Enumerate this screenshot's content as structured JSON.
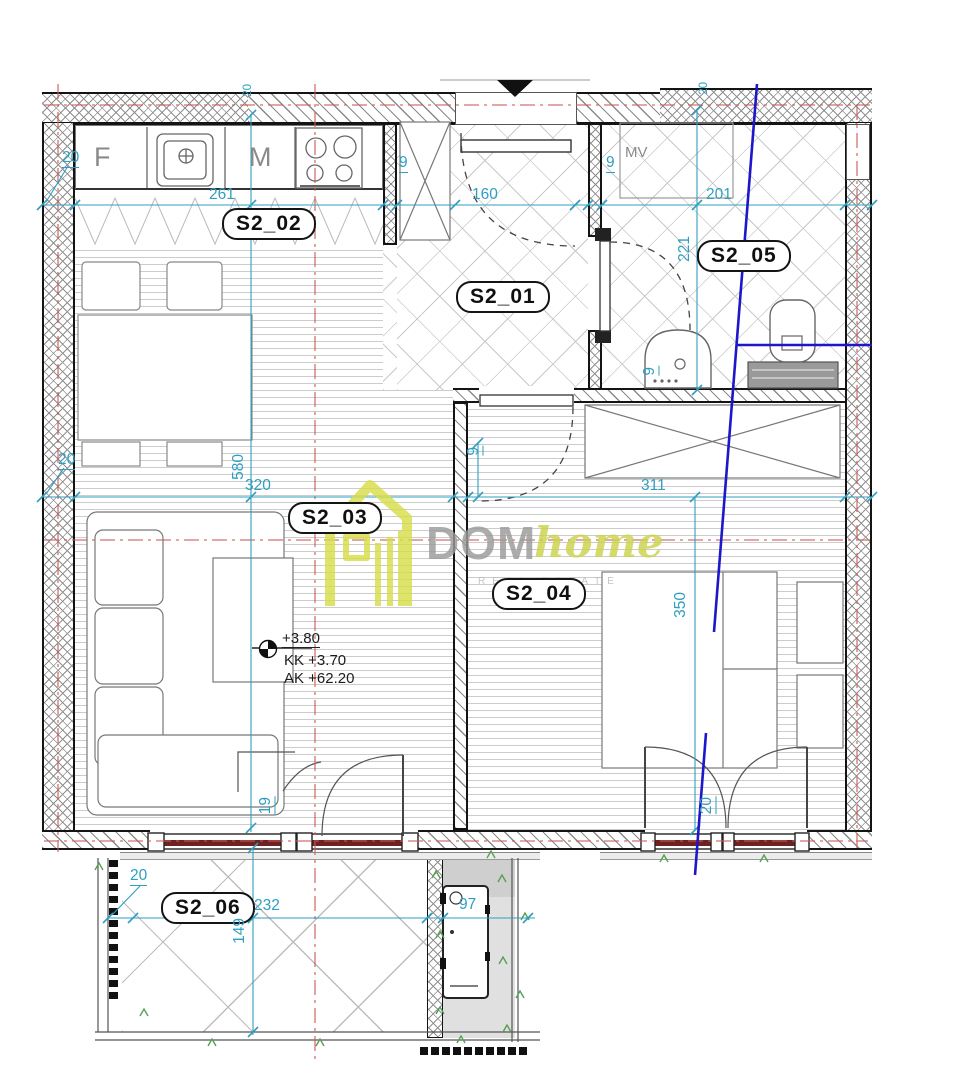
{
  "rooms": [
    {
      "id": "S2_02",
      "label": "S2_02"
    },
    {
      "id": "S2_01",
      "label": "S2_01"
    },
    {
      "id": "S2_05",
      "label": "S2_05"
    },
    {
      "id": "S2_03",
      "label": "S2_03"
    },
    {
      "id": "S2_04",
      "label": "S2_04"
    },
    {
      "id": "S2_06",
      "label": "S2_06"
    }
  ],
  "annotations": {
    "fridge": "F",
    "kitchen": "M",
    "washing_machine": "MV"
  },
  "levels": {
    "floor": "+3.80",
    "kk": "KK +3.70",
    "ak": "AK +62.20"
  },
  "dims": {
    "d20_kitchen": "20",
    "d261": "261",
    "d9_kwall": "9",
    "d160": "160",
    "d9_hwall": "9",
    "d201": "201",
    "d20_axis_left": "20",
    "d20_axis_right": "20",
    "d221": "221",
    "d20_living": "20",
    "d580": "580",
    "d320": "320",
    "d9_midwall": "9",
    "d311": "311",
    "d350": "350",
    "d9_sink": "9",
    "d19_door": "19",
    "d20_beddoor": "20",
    "d20_balcony": "20",
    "d232": "232",
    "d149": "149",
    "d97": "97"
  },
  "logo": {
    "dom": "DOM",
    "home": "home",
    "tagline": "REAL ESTATE"
  },
  "colors": {
    "dim_blue": "#2f9fc0",
    "axis_red": "#cb5a55",
    "section_blue": "#1d17c9",
    "logo_green": "#d7dd4a",
    "logo_gray": "#9b9b9b",
    "window_core": "#6e2222"
  }
}
